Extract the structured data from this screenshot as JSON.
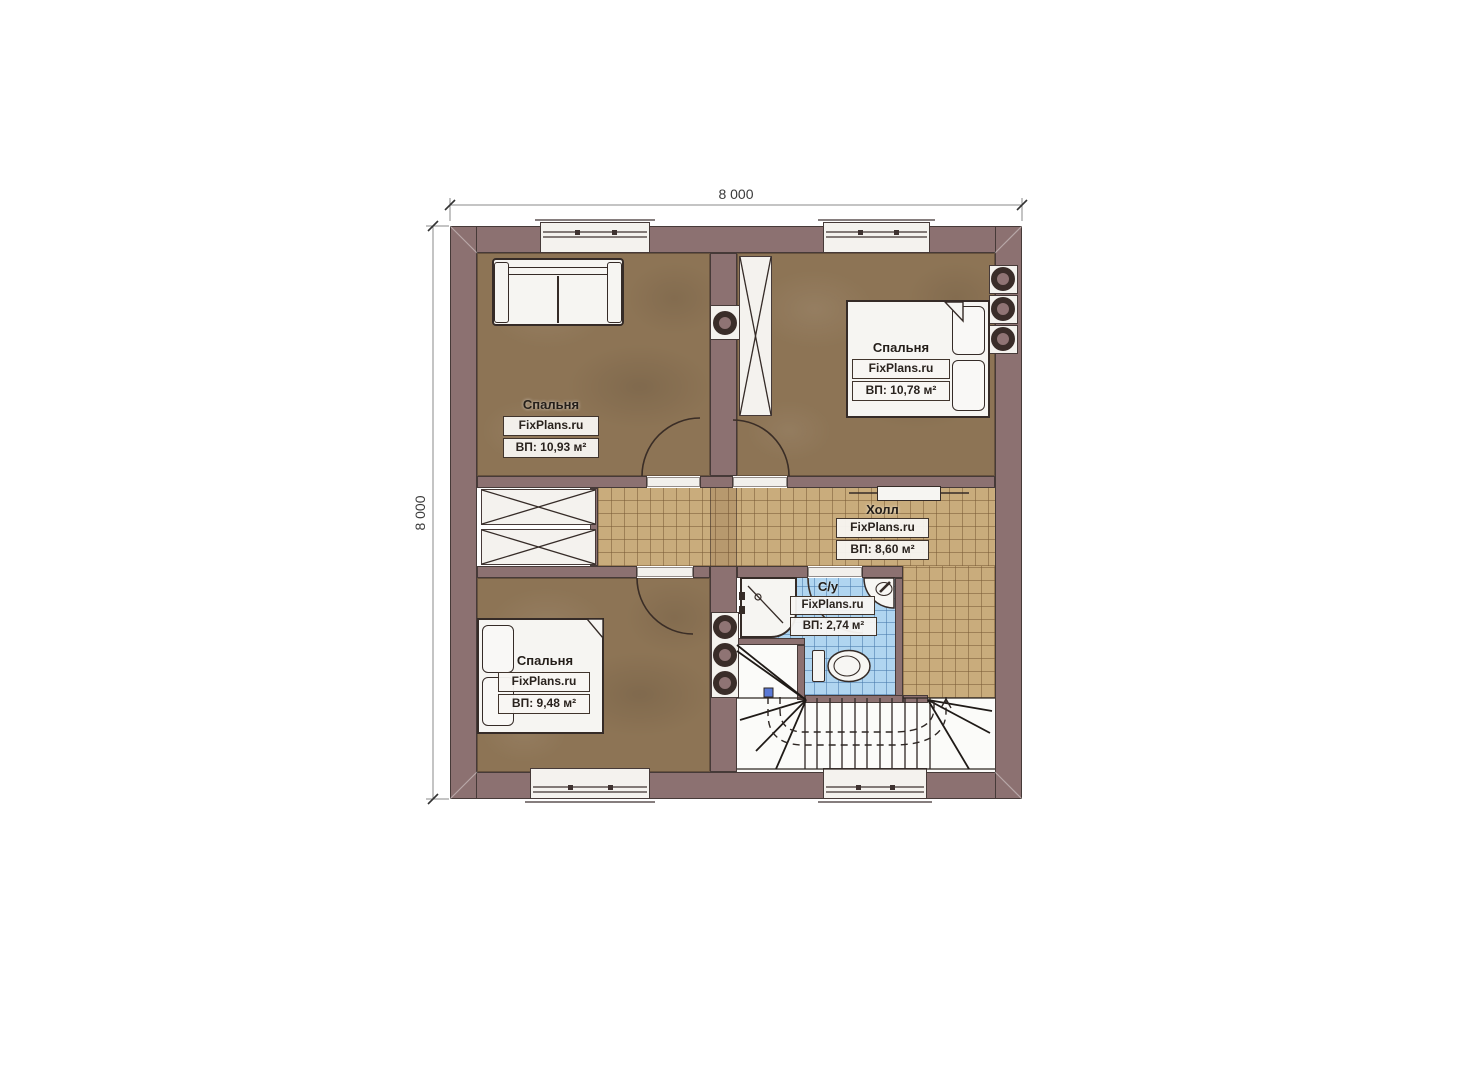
{
  "plan": {
    "title": "Floor plan second level",
    "brand": "FixPlans.ru",
    "dimensions": {
      "top": "8 000",
      "left": "8 000"
    },
    "rooms": [
      {
        "name": "Спальня",
        "brand": "FixPlans.ru",
        "area": "ВП: 10,93 м²"
      },
      {
        "name": "Спальня",
        "brand": "FixPlans.ru",
        "area": "ВП: 10,78 м²"
      },
      {
        "name": "Холл",
        "brand": "FixPlans.ru",
        "area": "ВП: 8,60 м²"
      },
      {
        "name": "С/у",
        "brand": "FixPlans.ru",
        "area": "ВП: 2,74 м²"
      },
      {
        "name": "Спальня",
        "brand": "FixPlans.ru",
        "area": "ВП: 9,48 м²"
      }
    ],
    "colors": {
      "wall": "#8C7171",
      "bedroom_floor": "#8D7455",
      "hall_tile": "#C9AC7C",
      "bath_tile": "#B0D5F0",
      "outline": "#3A2D26"
    }
  }
}
